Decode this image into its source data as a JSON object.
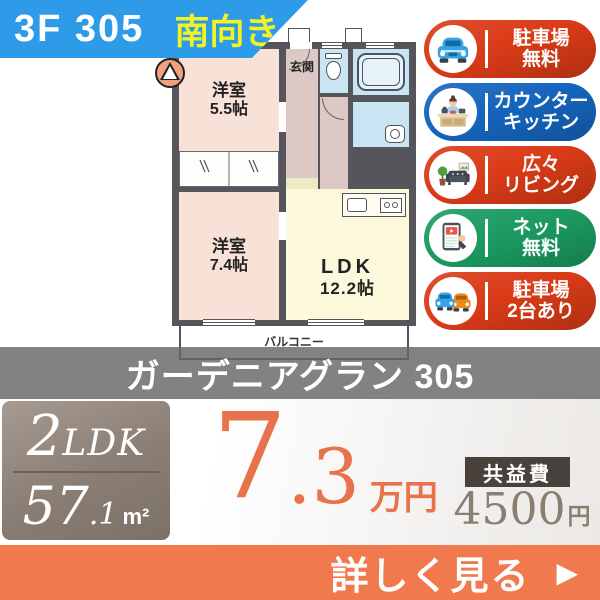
{
  "header": {
    "floor_unit": "3F 305",
    "facing": "南向き",
    "banner_color": "#2D9BE8",
    "facing_color": "#F3F321"
  },
  "floorplan": {
    "rooms": {
      "bedroom1": {
        "name": "洋室",
        "size": "5.5帖"
      },
      "bedroom2": {
        "name": "洋室",
        "size": "7.4帖"
      },
      "ldk": {
        "name": "LDK",
        "size": "12.2帖"
      },
      "entrance": {
        "name": "玄関"
      },
      "balcony": {
        "name": "バルコニー"
      }
    },
    "colors": {
      "wall": "#56555B",
      "bedroom": "#F8E1D7",
      "hall": "#DCC8C4",
      "wet_rooms": "#C9E4F3",
      "ldk": "#FBF8DC"
    }
  },
  "badges": [
    {
      "line1": "駐車場",
      "line2": "無料",
      "color": "#DA3B17",
      "icon": "car-front-icon"
    },
    {
      "line1": "カウンター",
      "line2": "キッチン",
      "color": "#1565BE",
      "icon": "counter-kitchen-icon"
    },
    {
      "line1": "広々",
      "line2": "リビング",
      "color": "#DA3B17",
      "icon": "living-room-icon"
    },
    {
      "line1": "ネット",
      "line2": "無料",
      "color": "#1B9B61",
      "icon": "tablet-video-icon"
    },
    {
      "line1": "駐車場",
      "line2": "2台あり",
      "color": "#DA3B17",
      "icon": "two-cars-icon"
    }
  ],
  "building": {
    "name": "ガーデニアグラン 305"
  },
  "summary": {
    "layout_number": "2",
    "layout_type": "LDK",
    "area_value": "57",
    "area_decimal": ".1",
    "area_unit": "m²",
    "rent_value": "7",
    "rent_decimal": ".3",
    "rent_unit": "万円",
    "rent_color": "#E7724B",
    "fee_label": "共益費",
    "fee_value": "4500",
    "fee_unit": "円"
  },
  "cta": {
    "label": "詳しく見る",
    "arrow": "▶",
    "color": "#F0794E"
  }
}
